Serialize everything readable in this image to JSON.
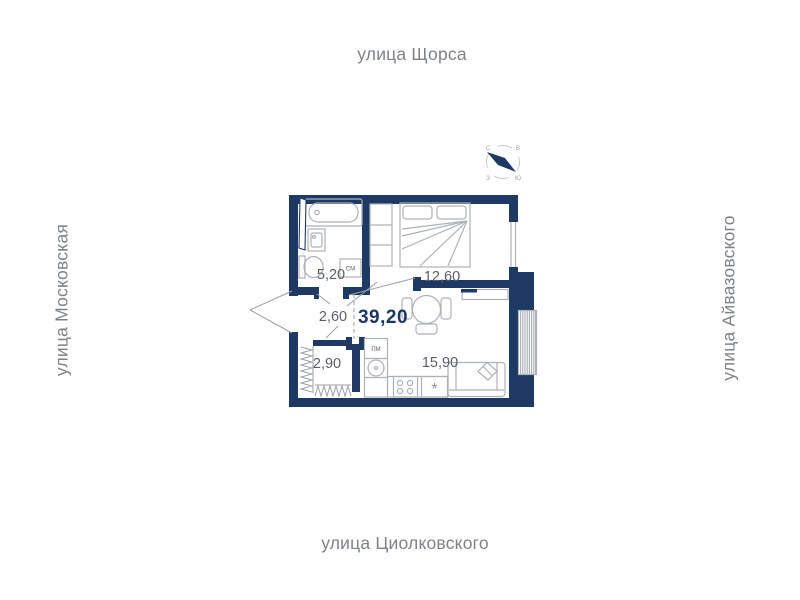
{
  "streets": {
    "top": "улица Щорса",
    "left": "улица Московская",
    "right": "улица Айвазовского",
    "bottom": "улица Циолковского"
  },
  "apartment": {
    "total_area": "39,20",
    "areas": {
      "bathroom": "5,20",
      "bedroom": "12,60",
      "hallway": "2,60",
      "closet": "2,90",
      "kitchen_living": "15,90"
    },
    "appliances": {
      "washing_machine": "СМ",
      "dishwasher": "ПМ",
      "freezer_symbol": "*"
    }
  },
  "compass": {
    "north": "С",
    "east": "В",
    "west": "З",
    "south": "Ю"
  },
  "colors": {
    "wall": "#1e3a64",
    "furn": "#adb2b7",
    "lead": "#9aa0a6",
    "room-label": "#5b6066",
    "street": "#7e8387",
    "total": "#1c3766"
  }
}
